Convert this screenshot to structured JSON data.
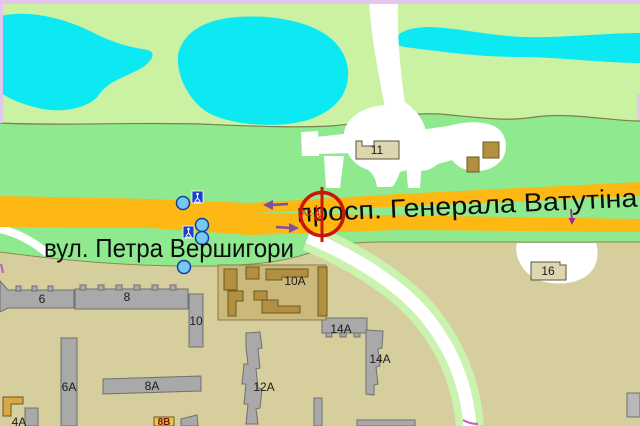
{
  "map": {
    "street_labels": {
      "avenue": "просп. Генерала Ватутіна",
      "street": "вул. Петра Вершигори"
    },
    "marker": {
      "code": "А2-4"
    },
    "buildings": {
      "b6": "6",
      "b8": "8",
      "b10": "10",
      "b11": "11",
      "b16": "16",
      "b10a": "10А",
      "b14a_top": "14А",
      "b14a_mid": "14А",
      "b6a": "6А",
      "b8a": "8А",
      "b12a": "12А",
      "b4a": "4А",
      "b8v": "8В"
    },
    "icons": {
      "pedestrian_crossing": "pedestrian-crossing-sign",
      "poi": "poi-circle-marker",
      "crosshair": "billboard-location-marker"
    },
    "colors": {
      "water": "#0de9f2",
      "park_light": "#cbf2a3",
      "grass": "#8fe98f",
      "road_orange": "#fdb813",
      "district_tan": "#d6cf9d",
      "plaza_tan": "#cbb97b",
      "building_gray": "#a9a9a9",
      "building_brown": "#b3903f",
      "building_khaki": "#ded6ae",
      "margin_pink": "#e3c7ef",
      "marker_red": "#cc1505",
      "arrow_purple": "#7b4fa6",
      "poi_blue": "#74c9f0",
      "sign_blue": "#1b3fd0"
    }
  }
}
